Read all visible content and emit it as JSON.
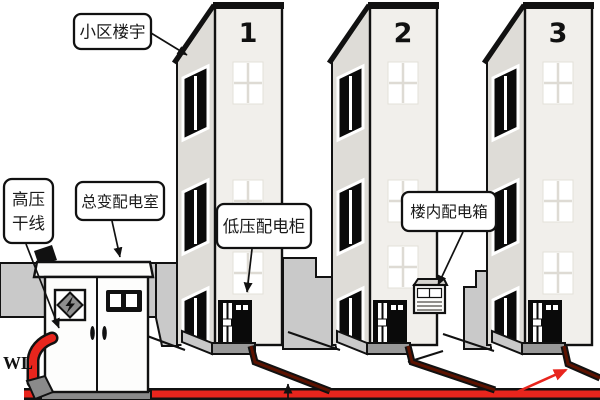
{
  "scene": "residential-community-power-distribution-diagram",
  "labels": {
    "community_building": "小区楼宇",
    "hv_trunk_line1": "高压",
    "hv_trunk_line2": "干线",
    "main_transformer_room": "总变配电室",
    "lv_distribution_cabinet": "低压配电柜",
    "indoor_distribution_box": "楼内配电箱",
    "wl": "WL"
  },
  "buildings": [
    {
      "number": "1"
    },
    {
      "number": "2"
    },
    {
      "number": "3"
    }
  ],
  "colors": {
    "cable_red": "#e8251d",
    "cable_dark_core": "#5c1200",
    "wall_gray": "#c9c9c9",
    "building_front": "#f1efeb",
    "building_side": "#dedcd7",
    "outline": "#111111"
  }
}
